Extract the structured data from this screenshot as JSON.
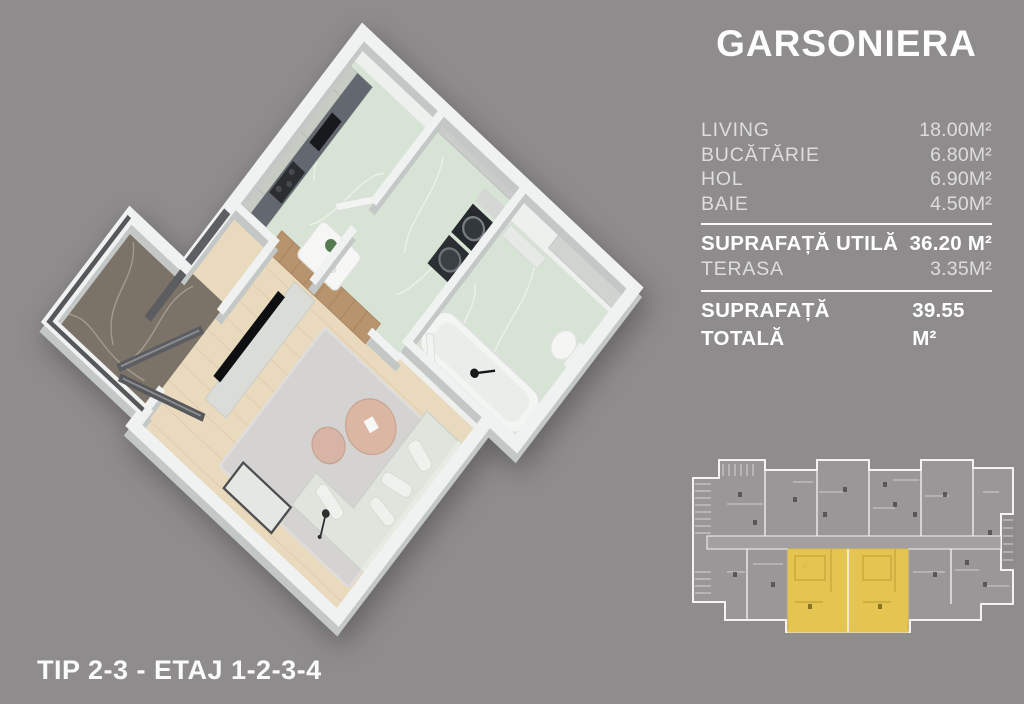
{
  "title": "GARSONIERA",
  "caption": "TIP 2-3 - ETAJ 1-2-3-4",
  "area_table": {
    "rows": [
      {
        "label": "LIVING",
        "value": "18.00M²"
      },
      {
        "label": "BUCĂTĂRIE",
        "value": "6.80M²"
      },
      {
        "label": "HOL",
        "value": "6.90M²"
      },
      {
        "label": "BAIE",
        "value": "4.50M²"
      }
    ],
    "subtotal": {
      "label": "SUPRAFAȚĂ UTILĂ",
      "value": "36.20 M²"
    },
    "terrace": {
      "label": "TERASA",
      "value": "3.35M²"
    },
    "total": {
      "label": "SUPRAFAȚĂ TOTALĂ",
      "value": "39.55 M²"
    }
  },
  "palette": {
    "background": "#8f8c8d",
    "wall_white": "#f0f2f1",
    "wall_shadow": "#c3c7c6",
    "floor_marble_green": "#d7e3d4",
    "floor_wood": "#e9d9bd",
    "floor_terrace_marble": "#7b7268",
    "rug": "#d4d3d1",
    "minimap_line": "#f4f3f2"
  },
  "minimap": {
    "highlight_color": "#ecc94b"
  }
}
